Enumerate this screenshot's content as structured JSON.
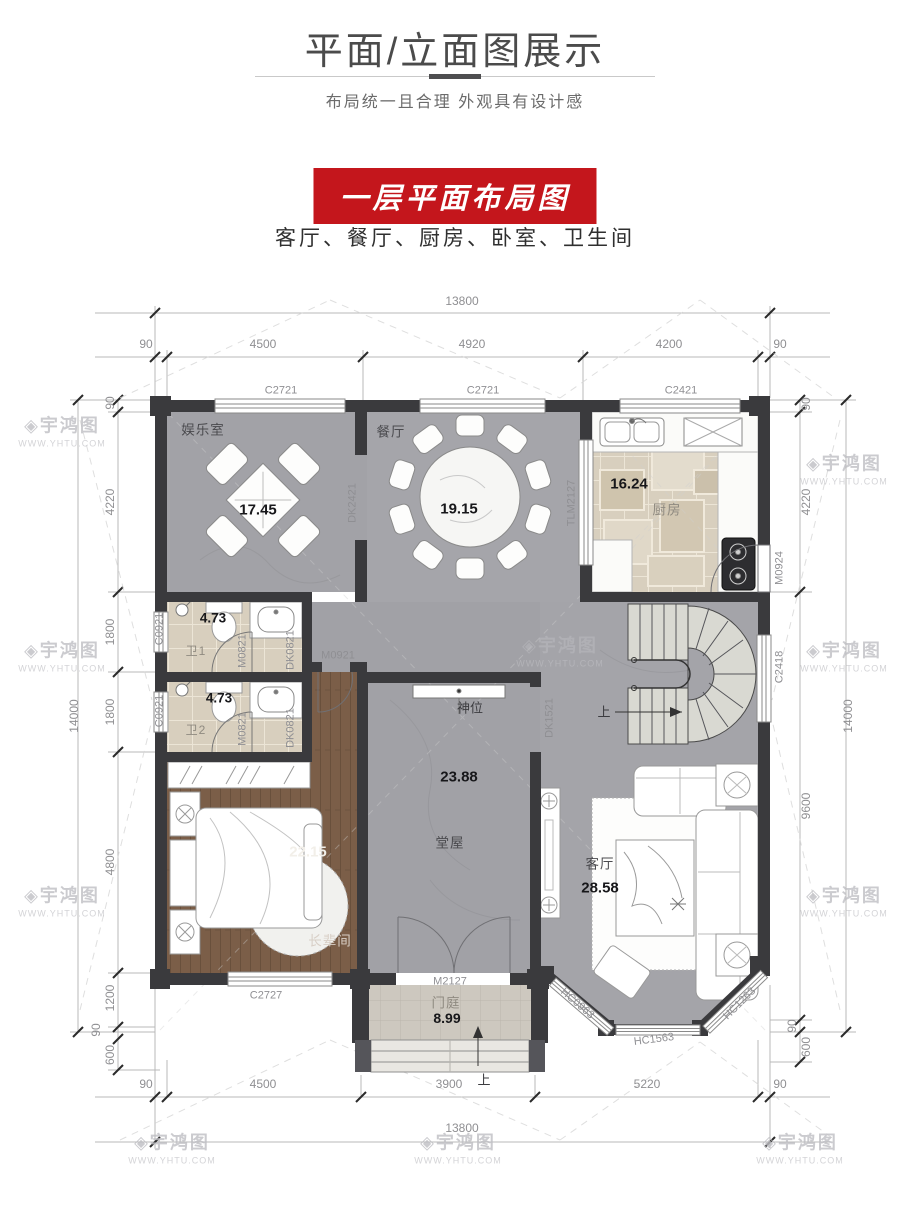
{
  "header": {
    "title": "平面/立面图展示",
    "subtitle": "布局统一且合理  外观具有设计感"
  },
  "banner": {
    "label": "一层平面布局图",
    "bg_color": "#c4161c"
  },
  "rooms_line": "客厅、餐厅、厨房、卧室、卫生间",
  "watermark": {
    "logo": "宇鸿图",
    "url": "WWW.YHTU.COM"
  },
  "plan": {
    "dims": {
      "top_total": "13800",
      "bottom_total": "13800",
      "left_total": "14000",
      "right_total": "14000",
      "top": [
        "90",
        "4500",
        "4920",
        "4200",
        "90"
      ],
      "bottom": [
        "90",
        "4500",
        "3900",
        "5220",
        "90"
      ],
      "left": [
        "90",
        "4220",
        "1800",
        "1800",
        "4800",
        "1200",
        "90",
        "600"
      ],
      "right": [
        "90",
        "4220",
        "9600",
        "90",
        "600"
      ]
    },
    "rooms": {
      "entertainment": {
        "name": "娱乐室",
        "area": "17.45"
      },
      "dining": {
        "name": "餐厅",
        "area": "19.15"
      },
      "kitchen": {
        "name": "厨房",
        "area": "16.24"
      },
      "bath1": {
        "name": "卫1",
        "area": "4.73"
      },
      "bath2": {
        "name": "卫2",
        "area": "4.73"
      },
      "bedroom": {
        "name": "长辈间",
        "area": "22.15"
      },
      "hall": {
        "name": "堂屋",
        "area": "23.88"
      },
      "living": {
        "name": "客厅",
        "area": "28.58"
      },
      "foyer": {
        "name": "门庭",
        "area": "8.99"
      }
    },
    "openings": {
      "c2721a": "C2721",
      "c2721b": "C2721",
      "c2421": "C2421",
      "c0921a": "C0921",
      "c0921b": "C0921",
      "c2727": "C2727",
      "c2418": "C2418",
      "tlm2127": "TLM2127",
      "m0924": "M0924",
      "m0921": "M0921",
      "m0821a": "M0821",
      "m0821b": "M0821",
      "dk0821a": "DK0821",
      "dk0821b": "DK0821",
      "dk2421": "DK2421",
      "dk1521": "DK1521",
      "m2127": "M2127",
      "hc0963": "HC0963",
      "hc1563": "HC1563",
      "hc1263": "HC1263"
    },
    "annotations": {
      "shrine": "神位",
      "up_stairs": "上",
      "up_entry": "上"
    }
  }
}
